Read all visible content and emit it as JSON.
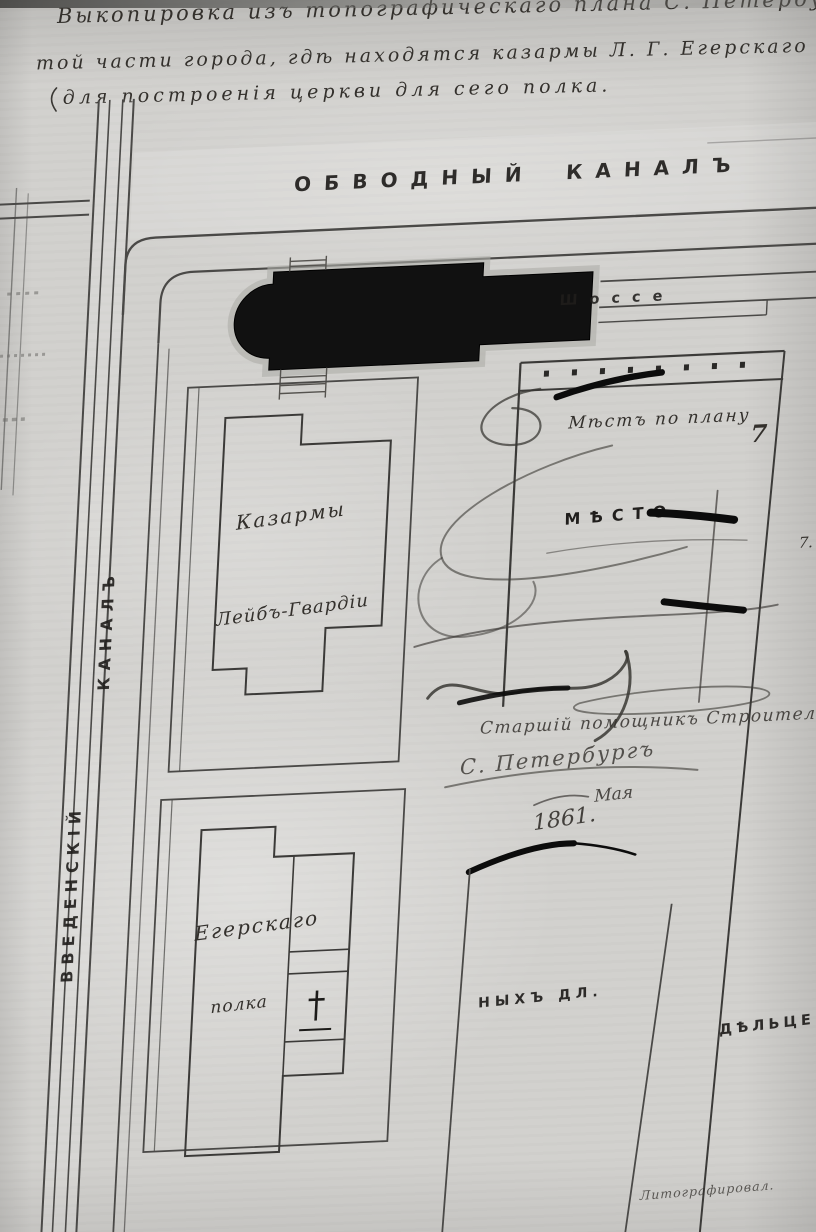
{
  "header": {
    "line1": "Выкопировка изъ топографическаго плана С. Петербурга,",
    "line2": "той части города, гдѣ находятся казармы Л. Г. Егерскаго полка,",
    "line3": "для построенія церкви для сего полка."
  },
  "waterways": {
    "obvodny_word1": "ОБВОДНЫЙ",
    "obvodny_word2": "КАНАЛЪ",
    "vvedensky_word1": "ВВЕДЕНСКІЙ",
    "vvedensky_word2": "КАНАЛЪ"
  },
  "roads": {
    "shosse": "Шоссе"
  },
  "buildings": {
    "guards_barracks": {
      "line1": "Казармы",
      "line2": "Лейбъ-Гвардіи"
    },
    "jaeger_barracks": {
      "line1": "Егерскаго",
      "line2": "полка"
    }
  },
  "right_block": {
    "plan_note": "Мѣстъ по плану",
    "plan_number": "7",
    "place_label": "МѢСТО",
    "edge_number": "7."
  },
  "inscriptions": {
    "official": "Старшій помощникъ Строительнаго от",
    "city": "С. Петербургъ",
    "month": "Мая",
    "year": "1861.",
    "parcel_fragment_left": "НЫХЪ ДЛ.",
    "parcel_fragment_right": "ДѢЛЬЦЕВЪ",
    "lithography": "Литографировал."
  },
  "colors": {
    "paper": "#d2d1ce",
    "map_line": "#4a4947",
    "ink": "#0c0c0c",
    "church_fill": "#111111"
  }
}
